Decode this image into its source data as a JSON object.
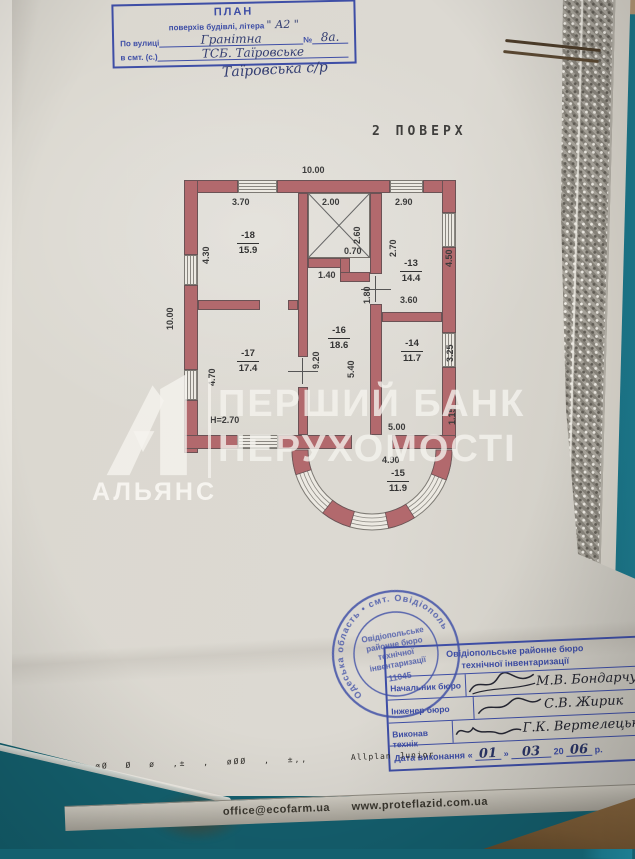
{
  "header_stamp": {
    "title": "ПЛАН",
    "subtitle": "поверхів будівлі, літера",
    "letter_value": "\" А2 \"",
    "street_label": "По вулиці",
    "street_value": "Гранітна",
    "number_label": "№",
    "number_value": "8а.",
    "settlement_label": "в смт. (с.)",
    "settlement_value": "ТСБ. Таїровське",
    "handwritten_below": "Таїровська с/р"
  },
  "plan": {
    "title": "2 ПОВЕРХ",
    "rooms": [
      {
        "num": "-18",
        "area": "15.9"
      },
      {
        "num": "-13",
        "area": "14.4"
      },
      {
        "num": "-17",
        "area": "17.4"
      },
      {
        "num": "-16",
        "area": "18.6"
      },
      {
        "num": "-14",
        "area": "11.7"
      },
      {
        "num": "-15",
        "area": "11.9"
      }
    ],
    "dims": {
      "top": "10.00",
      "left": "10.00",
      "d370": "3.70",
      "d200": "2.00",
      "d290": "2.90",
      "d260": "2.60",
      "d270": "2.70",
      "d430": "4.30",
      "d450": "4.50",
      "d070": "0.70",
      "d140": "1.40",
      "d180": "1.80",
      "d360": "3.60",
      "d470": "4.70",
      "d920": "9.20",
      "d540": "5.40",
      "d325": "3.25",
      "d115": "1.15",
      "d500": "5.00",
      "d490": "4.90",
      "height": "H=2.70"
    }
  },
  "watermark": {
    "bank_line1": "ПЕРШИЙ БАНК",
    "bank_line2": "НЕРУХОМОСТІ",
    "alliance": "АЛЬЯНС"
  },
  "round_stamp": {
    "ring_text": "Одеська область • смт. Овідіополь",
    "lines": [
      "Овідіопольське",
      "районне бюро",
      "технічної",
      "інвентаризації"
    ],
    "number": "11045"
  },
  "sig_table": {
    "header1": "Овідіопольське районне бюро",
    "header2": "технічної інвентаризації",
    "rows": [
      {
        "label": "Начальник бюро",
        "name": "М.В. Бондарчук"
      },
      {
        "label": "Інженер бюро",
        "name": "С.В. Жирик"
      },
      {
        "label": "Виконав технік",
        "name": "Г.К. Вертелецька"
      }
    ],
    "date_label": "Дата виконання",
    "q_open": "«",
    "day": "01",
    "q_close": "»",
    "month": "03",
    "century": "20",
    "year": "06",
    "suffix": "р."
  },
  "footer": {
    "symbols": "øØ  Ø  ø  ,±  ,  øØØ ,  ±,,",
    "software": "Allplan Junior"
  },
  "ruler": {
    "email": "office@ecofarm.ua",
    "site": "www.proteflazid.com.ua"
  }
}
